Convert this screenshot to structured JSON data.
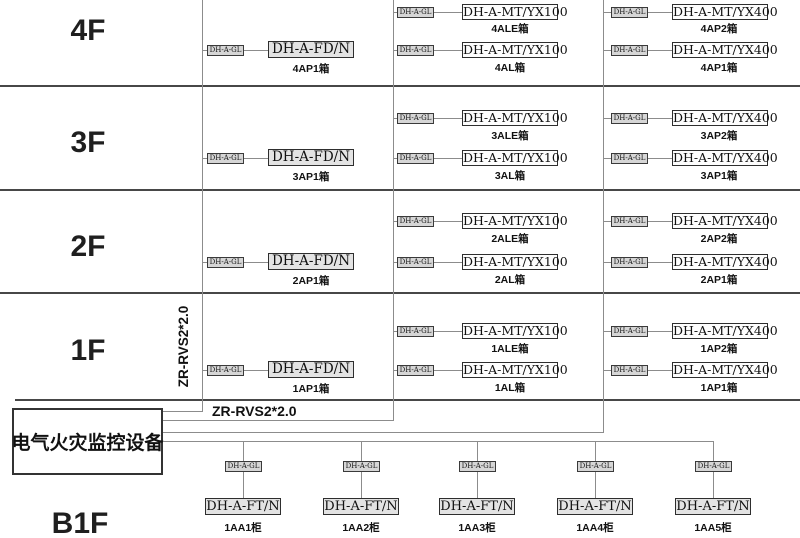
{
  "diagram_title": "电气火灾监控系统图",
  "colors": {
    "background": "#ffffff",
    "separator_line": "#474747",
    "wire_line": "#8c8c8c",
    "box_border": "#2e2e2e",
    "gl_box_fill": "#d6d6d6",
    "shaded_box_fill": "#e3e3e3"
  },
  "floors": [
    {
      "label": "4F",
      "left": {
        "gl": "DH-A-GL",
        "device": "DH-A-FD/N",
        "name": "4AP1箱"
      },
      "middle": [
        {
          "gl": "DH-A-GL",
          "device": "DH-A-MT/YX100",
          "name": "4ALE箱"
        },
        {
          "gl": "DH-A-GL",
          "device": "DH-A-MT/YX100",
          "name": "4AL箱"
        }
      ],
      "right": [
        {
          "gl": "DH-A-GL",
          "device": "DH-A-MT/YX400",
          "name": "4AP2箱"
        },
        {
          "gl": "DH-A-GL",
          "device": "DH-A-MT/YX400",
          "name": "4AP1箱"
        }
      ]
    },
    {
      "label": "3F",
      "left": {
        "gl": "DH-A-GL",
        "device": "DH-A-FD/N",
        "name": "3AP1箱"
      },
      "middle": [
        {
          "gl": "DH-A-GL",
          "device": "DH-A-MT/YX100",
          "name": "3ALE箱"
        },
        {
          "gl": "DH-A-GL",
          "device": "DH-A-MT/YX100",
          "name": "3AL箱"
        }
      ],
      "right": [
        {
          "gl": "DH-A-GL",
          "device": "DH-A-MT/YX400",
          "name": "3AP2箱"
        },
        {
          "gl": "DH-A-GL",
          "device": "DH-A-MT/YX400",
          "name": "3AP1箱"
        }
      ]
    },
    {
      "label": "2F",
      "left": {
        "gl": "DH-A-GL",
        "device": "DH-A-FD/N",
        "name": "2AP1箱"
      },
      "middle": [
        {
          "gl": "DH-A-GL",
          "device": "DH-A-MT/YX100",
          "name": "2ALE箱"
        },
        {
          "gl": "DH-A-GL",
          "device": "DH-A-MT/YX100",
          "name": "2AL箱"
        }
      ],
      "right": [
        {
          "gl": "DH-A-GL",
          "device": "DH-A-MT/YX400",
          "name": "2AP2箱"
        },
        {
          "gl": "DH-A-GL",
          "device": "DH-A-MT/YX400",
          "name": "2AP1箱"
        }
      ]
    },
    {
      "label": "1F",
      "left": {
        "gl": "DH-A-GL",
        "device": "DH-A-FD/N",
        "name": "1AP1箱"
      },
      "middle": [
        {
          "gl": "DH-A-GL",
          "device": "DH-A-MT/YX100",
          "name": "1ALE箱"
        },
        {
          "gl": "DH-A-GL",
          "device": "DH-A-MT/YX100",
          "name": "1AL箱"
        }
      ],
      "right": [
        {
          "gl": "DH-A-GL",
          "device": "DH-A-MT/YX400",
          "name": "1AP2箱"
        },
        {
          "gl": "DH-A-GL",
          "device": "DH-A-MT/YX400",
          "name": "1AP1箱"
        }
      ]
    }
  ],
  "basement": {
    "label": "B1F",
    "cabinets": [
      {
        "gl": "DH-A-GL",
        "device": "DH-A-FT/N",
        "name": "1AA1柜"
      },
      {
        "gl": "DH-A-GL",
        "device": "DH-A-FT/N",
        "name": "1AA2柜"
      },
      {
        "gl": "DH-A-GL",
        "device": "DH-A-FT/N",
        "name": "1AA3柜"
      },
      {
        "gl": "DH-A-GL",
        "device": "DH-A-FT/N",
        "name": "1AA4柜"
      },
      {
        "gl": "DH-A-GL",
        "device": "DH-A-FT/N",
        "name": "1AA5柜"
      }
    ]
  },
  "monitor": {
    "label": "电气火灾监控设备"
  },
  "cables": {
    "riser_label": "ZR-RVS2*2.0",
    "feeder_label": "ZR-RVS2*2.0"
  }
}
